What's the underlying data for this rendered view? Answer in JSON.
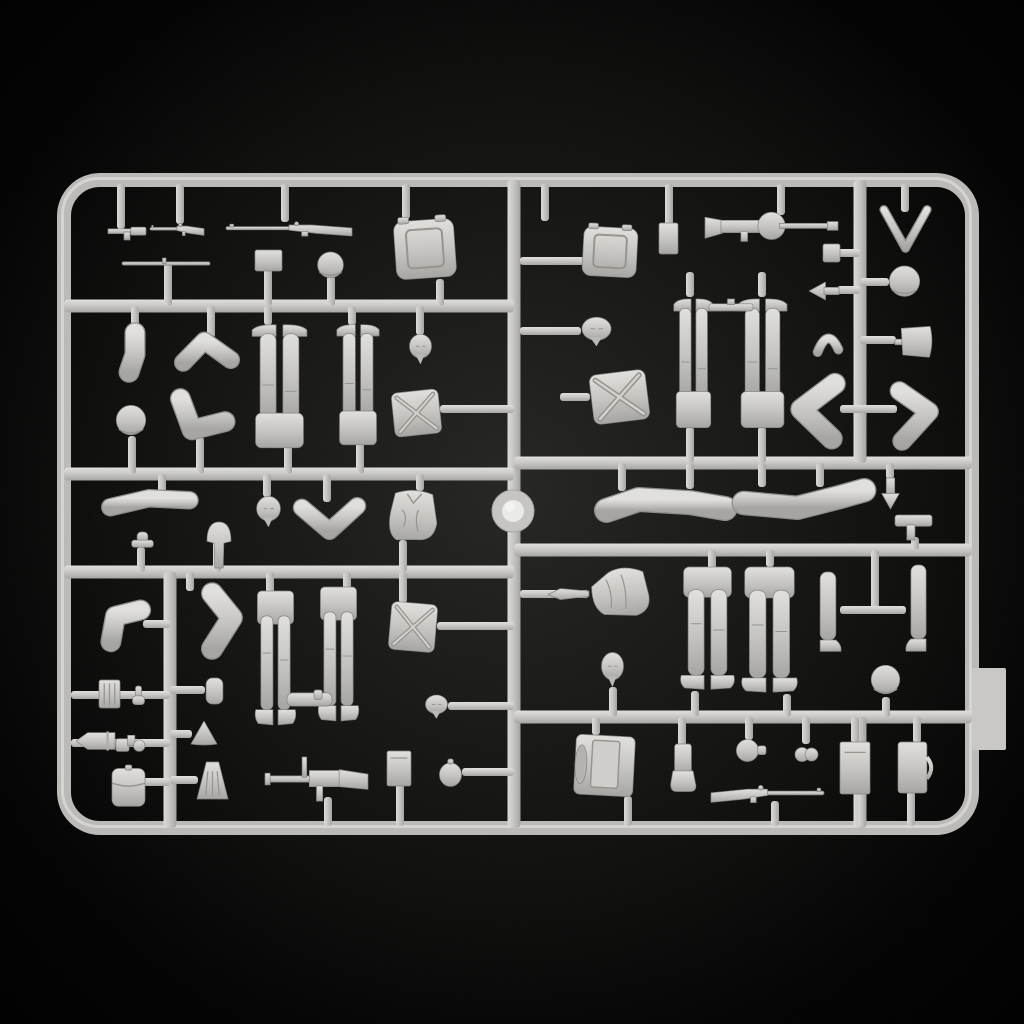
{
  "scene": {
    "description": "Product photo of an unpainted light-grey injection-molded styrene sprue of 1/35 scale soldier figure parts on a black background",
    "canvas": {
      "width": 1024,
      "height": 1024
    },
    "colors": {
      "background": "#000000",
      "glow": "#232322",
      "plastic_base": "#c4c3c0",
      "plastic_light": "#e1e0dd",
      "plastic_dark": "#a5a4a1",
      "plastic_shadow": "#8b8a86",
      "detail_line": "#94938e",
      "ring_inner": "#ebebe9"
    }
  },
  "frame": {
    "outer": {
      "x": 64,
      "y": 180,
      "width": 908,
      "height": 648,
      "corner_radius": 36,
      "thickness": 14
    },
    "center_runner_x": 514,
    "left_runners_y": [
      306,
      474,
      572
    ],
    "right_runners_y": [
      463,
      550,
      717
    ],
    "sub_runners": [
      {
        "x": 170,
        "y1": 572,
        "y2": 828
      },
      {
        "x": 860,
        "y1": 180,
        "y2": 463
      },
      {
        "x": 860,
        "y1": 717,
        "y2": 828
      }
    ],
    "locator_ring": {
      "cx": 513,
      "cy": 511,
      "outer_r": 21,
      "inner_r": 11
    },
    "side_tab": {
      "x": 972,
      "y": 668,
      "width": 34,
      "height": 82
    }
  },
  "stubs": [
    [
      121,
      184,
      121,
      229
    ],
    [
      180,
      184,
      180,
      224
    ],
    [
      285,
      184,
      285,
      222
    ],
    [
      406,
      184,
      406,
      219
    ],
    [
      545,
      184,
      545,
      221
    ],
    [
      669,
      184,
      669,
      226
    ],
    [
      781,
      184,
      781,
      215
    ],
    [
      905,
      184,
      905,
      212
    ],
    [
      168,
      263,
      168,
      306
    ],
    [
      268,
      268,
      268,
      306
    ],
    [
      331,
      276,
      331,
      306
    ],
    [
      440,
      279,
      440,
      306
    ],
    [
      135,
      306,
      135,
      331
    ],
    [
      211,
      306,
      211,
      338
    ],
    [
      268,
      306,
      268,
      325
    ],
    [
      352,
      306,
      352,
      325
    ],
    [
      420,
      306,
      420,
      335
    ],
    [
      132,
      436,
      132,
      474
    ],
    [
      200,
      437,
      200,
      474
    ],
    [
      288,
      445,
      288,
      474
    ],
    [
      360,
      442,
      360,
      474
    ],
    [
      440,
      409,
      514,
      409
    ],
    [
      162,
      474,
      162,
      495
    ],
    [
      267,
      474,
      267,
      497
    ],
    [
      327,
      474,
      327,
      502
    ],
    [
      420,
      474,
      420,
      491
    ],
    [
      141,
      547,
      141,
      572
    ],
    [
      217,
      541,
      217,
      572
    ],
    [
      403,
      540,
      403,
      572
    ],
    [
      190,
      572,
      190,
      591
    ],
    [
      270,
      572,
      270,
      594
    ],
    [
      347,
      572,
      347,
      589
    ],
    [
      403,
      572,
      403,
      603
    ],
    [
      437,
      626,
      514,
      626
    ],
    [
      143,
      624,
      170,
      624
    ],
    [
      71,
      695,
      170,
      695
    ],
    [
      71,
      743,
      170,
      743
    ],
    [
      170,
      734,
      192,
      734
    ],
    [
      143,
      782,
      170,
      782
    ],
    [
      170,
      780,
      198,
      780
    ],
    [
      170,
      690,
      205,
      690
    ],
    [
      328,
      797,
      328,
      826
    ],
    [
      400,
      784,
      400,
      826
    ],
    [
      462,
      772,
      514,
      772
    ],
    [
      448,
      706,
      514,
      706
    ],
    [
      520,
      261,
      584,
      261
    ],
    [
      520,
      331,
      581,
      331
    ],
    [
      560,
      397,
      590,
      397
    ],
    [
      690,
      272,
      690,
      297
    ],
    [
      762,
      272,
      762,
      297
    ],
    [
      838,
      253,
      860,
      253
    ],
    [
      837,
      290,
      860,
      290
    ],
    [
      860,
      282,
      889,
      282
    ],
    [
      860,
      340,
      896,
      340
    ],
    [
      840,
      409,
      897,
      409
    ],
    [
      690,
      427,
      690,
      463
    ],
    [
      762,
      427,
      762,
      463
    ],
    [
      622,
      463,
      622,
      491
    ],
    [
      690,
      463,
      690,
      489
    ],
    [
      762,
      463,
      762,
      487
    ],
    [
      820,
      463,
      820,
      487
    ],
    [
      890,
      463,
      890,
      479
    ],
    [
      915,
      537,
      915,
      550
    ],
    [
      520,
      594,
      589,
      594
    ],
    [
      712,
      550,
      712,
      569
    ],
    [
      770,
      550,
      770,
      567
    ],
    [
      875,
      550,
      875,
      610
    ],
    [
      840,
      610,
      906,
      610
    ],
    [
      613,
      687,
      613,
      717
    ],
    [
      695,
      691,
      695,
      717
    ],
    [
      787,
      694,
      787,
      717
    ],
    [
      886,
      697,
      886,
      717
    ],
    [
      596,
      717,
      596,
      735
    ],
    [
      682,
      717,
      682,
      746
    ],
    [
      749,
      717,
      749,
      740
    ],
    [
      806,
      717,
      806,
      744
    ],
    [
      855,
      717,
      855,
      743
    ],
    [
      917,
      717,
      917,
      743
    ],
    [
      628,
      796,
      628,
      826
    ],
    [
      775,
      801,
      775,
      826
    ],
    [
      862,
      792,
      862,
      826
    ],
    [
      911,
      791,
      911,
      826
    ]
  ],
  "parts": [
    {
      "name": "pistol-part",
      "type": "pistol",
      "x": 108,
      "y": 224,
      "w": 38,
      "h": 16
    },
    {
      "name": "carbine-part",
      "type": "rifle",
      "x": 150,
      "y": 221,
      "w": 54,
      "h": 17
    },
    {
      "name": "mosin-rifle-top",
      "type": "rifle",
      "x": 226,
      "y": 219,
      "w": 126,
      "h": 20
    },
    {
      "name": "rifle-rod-part",
      "type": "rod",
      "x": 122,
      "y": 258,
      "w": 88,
      "h": 11
    },
    {
      "name": "ammo-pouch-small",
      "type": "rectv",
      "x": 255,
      "y": 250,
      "w": 27,
      "h": 21
    },
    {
      "name": "helmet-top-left",
      "type": "helmet",
      "x": 316,
      "y": 252,
      "w": 29,
      "h": 28
    },
    {
      "name": "backpack-top-left",
      "type": "packBig",
      "x": 395,
      "y": 216,
      "w": 60,
      "h": 66,
      "rot": -4
    },
    {
      "name": "sleeve-arm-part",
      "type": "armline",
      "variant": "sleeveV",
      "x": 120,
      "y": 328,
      "w": 30,
      "h": 48
    },
    {
      "name": "bent-arm-upper-left",
      "type": "armline",
      "variant": "chevUp",
      "x": 180,
      "y": 334,
      "w": 54,
      "h": 38
    },
    {
      "name": "helmet-row2",
      "type": "helmet",
      "x": 115,
      "y": 404,
      "w": 32,
      "h": 35
    },
    {
      "name": "bent-arm-fist",
      "type": "armline",
      "variant": "armL",
      "x": 170,
      "y": 394,
      "w": 58,
      "h": 46
    },
    {
      "name": "legs-inverted-1",
      "type": "legsUp",
      "x": 251,
      "y": 321,
      "w": 57,
      "h": 128
    },
    {
      "name": "legs-inverted-2",
      "type": "legsUp",
      "x": 336,
      "y": 321,
      "w": 44,
      "h": 125
    },
    {
      "name": "head-row2",
      "type": "head",
      "x": 408,
      "y": 333,
      "w": 25,
      "h": 33
    },
    {
      "name": "x-strap-pack-1",
      "type": "packX",
      "x": 391,
      "y": 389,
      "w": 51,
      "h": 48,
      "rot": -6
    },
    {
      "name": "rolled-sleeve-arm",
      "type": "armline",
      "variant": "rollH",
      "x": 104,
      "y": 488,
      "w": 90,
      "h": 32
    },
    {
      "name": "grenade-part-1",
      "type": "knob",
      "x": 129,
      "y": 532,
      "w": 27,
      "h": 18
    },
    {
      "name": "canteen-mushroom",
      "type": "mushroom",
      "x": 204,
      "y": 522,
      "w": 30,
      "h": 46
    },
    {
      "name": "head-row3",
      "type": "head",
      "x": 255,
      "y": 495,
      "w": 27,
      "h": 34
    },
    {
      "name": "bent-arm-chevron",
      "type": "armline",
      "variant": "chevDown",
      "x": 298,
      "y": 499,
      "w": 63,
      "h": 39
    },
    {
      "name": "torso-jacket-left",
      "type": "torsoV",
      "x": 385,
      "y": 489,
      "w": 55,
      "h": 54,
      "rot": 4
    },
    {
      "name": "elbow-arm-lower-left",
      "type": "armline",
      "variant": "elbowL",
      "x": 101,
      "y": 603,
      "w": 45,
      "h": 44
    },
    {
      "name": "arm-with-hand",
      "type": "armline",
      "variant": "armHand",
      "x": 198,
      "y": 588,
      "w": 47,
      "h": 66
    },
    {
      "name": "legs-standing-1",
      "type": "legsStand",
      "x": 254,
      "y": 591,
      "w": 43,
      "h": 138
    },
    {
      "name": "legs-standing-2",
      "type": "legsStand",
      "x": 317,
      "y": 587,
      "w": 43,
      "h": 138
    },
    {
      "name": "x-strap-pack-2",
      "type": "packX",
      "x": 388,
      "y": 601,
      "w": 50,
      "h": 52,
      "rot": 5
    },
    {
      "name": "holster-part",
      "type": "holster",
      "x": 287,
      "y": 690,
      "w": 45,
      "h": 19
    },
    {
      "name": "ammo-box-grille",
      "type": "grille",
      "x": 99,
      "y": 680,
      "w": 21,
      "h": 28
    },
    {
      "name": "knob-part",
      "type": "knob",
      "x": 131,
      "y": 686,
      "w": 15,
      "h": 22
    },
    {
      "name": "cylinder-pouch",
      "type": "cyl",
      "x": 204,
      "y": 678,
      "w": 21,
      "h": 26
    },
    {
      "name": "shell-part",
      "type": "shell",
      "x": 76,
      "y": 731,
      "w": 39,
      "h": 20
    },
    {
      "name": "mg-lock-part",
      "type": "mgpart",
      "x": 116,
      "y": 733,
      "w": 29,
      "h": 23
    },
    {
      "name": "cone-part",
      "type": "cone",
      "x": 191,
      "y": 721,
      "w": 26,
      "h": 25
    },
    {
      "name": "flap-pouch-large",
      "type": "pouch",
      "x": 112,
      "y": 765,
      "w": 33,
      "h": 43
    },
    {
      "name": "skirt-part",
      "type": "skirt",
      "x": 197,
      "y": 762,
      "w": 31,
      "h": 37
    },
    {
      "name": "mg-with-bipod",
      "type": "mgb",
      "x": 265,
      "y": 757,
      "w": 103,
      "h": 45
    },
    {
      "name": "box-part-left",
      "type": "boxv",
      "x": 387,
      "y": 751,
      "w": 24,
      "h": 35
    },
    {
      "name": "flask-oval",
      "type": "flaskO",
      "x": 439,
      "y": 759,
      "w": 23,
      "h": 28
    },
    {
      "name": "head-near-runner",
      "type": "head",
      "x": 424,
      "y": 694,
      "w": 25,
      "h": 26
    },
    {
      "name": "pouch-top-right-small",
      "type": "rectv",
      "x": 659,
      "y": 223,
      "w": 19,
      "h": 31
    },
    {
      "name": "dp-machine-gun",
      "type": "dp",
      "x": 705,
      "y": 211,
      "w": 133,
      "h": 31
    },
    {
      "name": "gate-arrow-marker",
      "type": "vmark",
      "x": 882,
      "y": 207,
      "w": 47,
      "h": 43
    },
    {
      "name": "small-box-right",
      "type": "rectv",
      "x": 823,
      "y": 244,
      "w": 17,
      "h": 18
    },
    {
      "name": "spade-arrow-part",
      "type": "spade",
      "x": 809,
      "y": 282,
      "w": 30,
      "h": 18
    },
    {
      "name": "helmet-top-right",
      "type": "helmet",
      "x": 888,
      "y": 266,
      "w": 33,
      "h": 33
    },
    {
      "name": "backpack-top-right",
      "type": "packBig",
      "x": 583,
      "y": 224,
      "w": 54,
      "h": 56,
      "rot": 3
    },
    {
      "name": "head-right-1",
      "type": "head",
      "x": 580,
      "y": 316,
      "w": 33,
      "h": 32
    },
    {
      "name": "curved-part",
      "type": "curved",
      "x": 815,
      "y": 330,
      "w": 26,
      "h": 26
    },
    {
      "name": "shovel-blade",
      "type": "shovel",
      "x": 895,
      "y": 325,
      "w": 39,
      "h": 34
    },
    {
      "name": "legs-inverted-3",
      "type": "legsUp",
      "x": 673,
      "y": 295,
      "w": 41,
      "h": 134
    },
    {
      "name": "legs-inverted-4",
      "type": "legsUp",
      "x": 737,
      "y": 295,
      "w": 51,
      "h": 134
    },
    {
      "name": "tool-bar-part",
      "type": "bar",
      "x": 709,
      "y": 299,
      "w": 44,
      "h": 16
    },
    {
      "name": "bent-arm-right-1",
      "type": "armline",
      "variant": "chevLeft",
      "x": 790,
      "y": 377,
      "w": 51,
      "h": 67
    },
    {
      "name": "bent-arm-right-2",
      "type": "armline",
      "variant": "chevRight",
      "x": 894,
      "y": 385,
      "w": 45,
      "h": 59
    },
    {
      "name": "x-strap-pack-3",
      "type": "packX",
      "x": 589,
      "y": 370,
      "w": 61,
      "h": 54,
      "rot": -7
    },
    {
      "name": "greatcoat-arm-1",
      "type": "armline",
      "variant": "coatL",
      "x": 600,
      "y": 487,
      "w": 129,
      "h": 39
    },
    {
      "name": "greatcoat-arm-2",
      "type": "armline",
      "variant": "coatR",
      "x": 740,
      "y": 483,
      "w": 128,
      "h": 40
    },
    {
      "name": "arrow-part-small",
      "type": "arrowv",
      "x": 880,
      "y": 478,
      "w": 21,
      "h": 31
    },
    {
      "name": "l-bar-part",
      "type": "lbar",
      "x": 895,
      "y": 515,
      "w": 37,
      "h": 25
    },
    {
      "name": "torso-jacket-right",
      "type": "torsoH",
      "x": 589,
      "y": 567,
      "w": 63,
      "h": 53,
      "rot": -8
    },
    {
      "name": "bayonet-part",
      "type": "bayonet",
      "x": 548,
      "y": 586,
      "w": 41,
      "h": 17
    },
    {
      "name": "head-right-2",
      "type": "head",
      "x": 600,
      "y": 651,
      "w": 25,
      "h": 38
    },
    {
      "name": "legs-standing-3",
      "type": "legsStand",
      "x": 679,
      "y": 567,
      "w": 57,
      "h": 126
    },
    {
      "name": "legs-standing-4",
      "type": "legsStand",
      "x": 740,
      "y": 567,
      "w": 59,
      "h": 129
    },
    {
      "name": "single-leg-1",
      "type": "legSingle",
      "x": 814,
      "y": 572,
      "w": 28,
      "h": 81
    },
    {
      "name": "single-leg-2",
      "type": "legSingle",
      "x": 905,
      "y": 565,
      "w": 27,
      "h": 88,
      "flip": true
    },
    {
      "name": "helmet-lower-right",
      "type": "helmet",
      "x": 870,
      "y": 663,
      "w": 31,
      "h": 36
    },
    {
      "name": "backpack-bottom-right",
      "type": "packFrame",
      "x": 575,
      "y": 733,
      "w": 59,
      "h": 65,
      "rot": 3
    },
    {
      "name": "boot-gaiter-part",
      "type": "gaiter",
      "x": 669,
      "y": 744,
      "w": 28,
      "h": 49
    },
    {
      "name": "canteen-round",
      "type": "canteenR",
      "x": 734,
      "y": 739,
      "w": 32,
      "h": 23
    },
    {
      "name": "grenade-part-2",
      "type": "grenade",
      "x": 794,
      "y": 743,
      "w": 25,
      "h": 23
    },
    {
      "name": "box-plain-right",
      "type": "boxv",
      "x": 840,
      "y": 742,
      "w": 30,
      "h": 52
    },
    {
      "name": "satchel-part",
      "type": "satchel",
      "x": 898,
      "y": 742,
      "w": 34,
      "h": 51
    },
    {
      "name": "mosin-rifle-bottom",
      "type": "rifle",
      "x": 711,
      "y": 782,
      "w": 113,
      "h": 24,
      "flip": true
    }
  ]
}
